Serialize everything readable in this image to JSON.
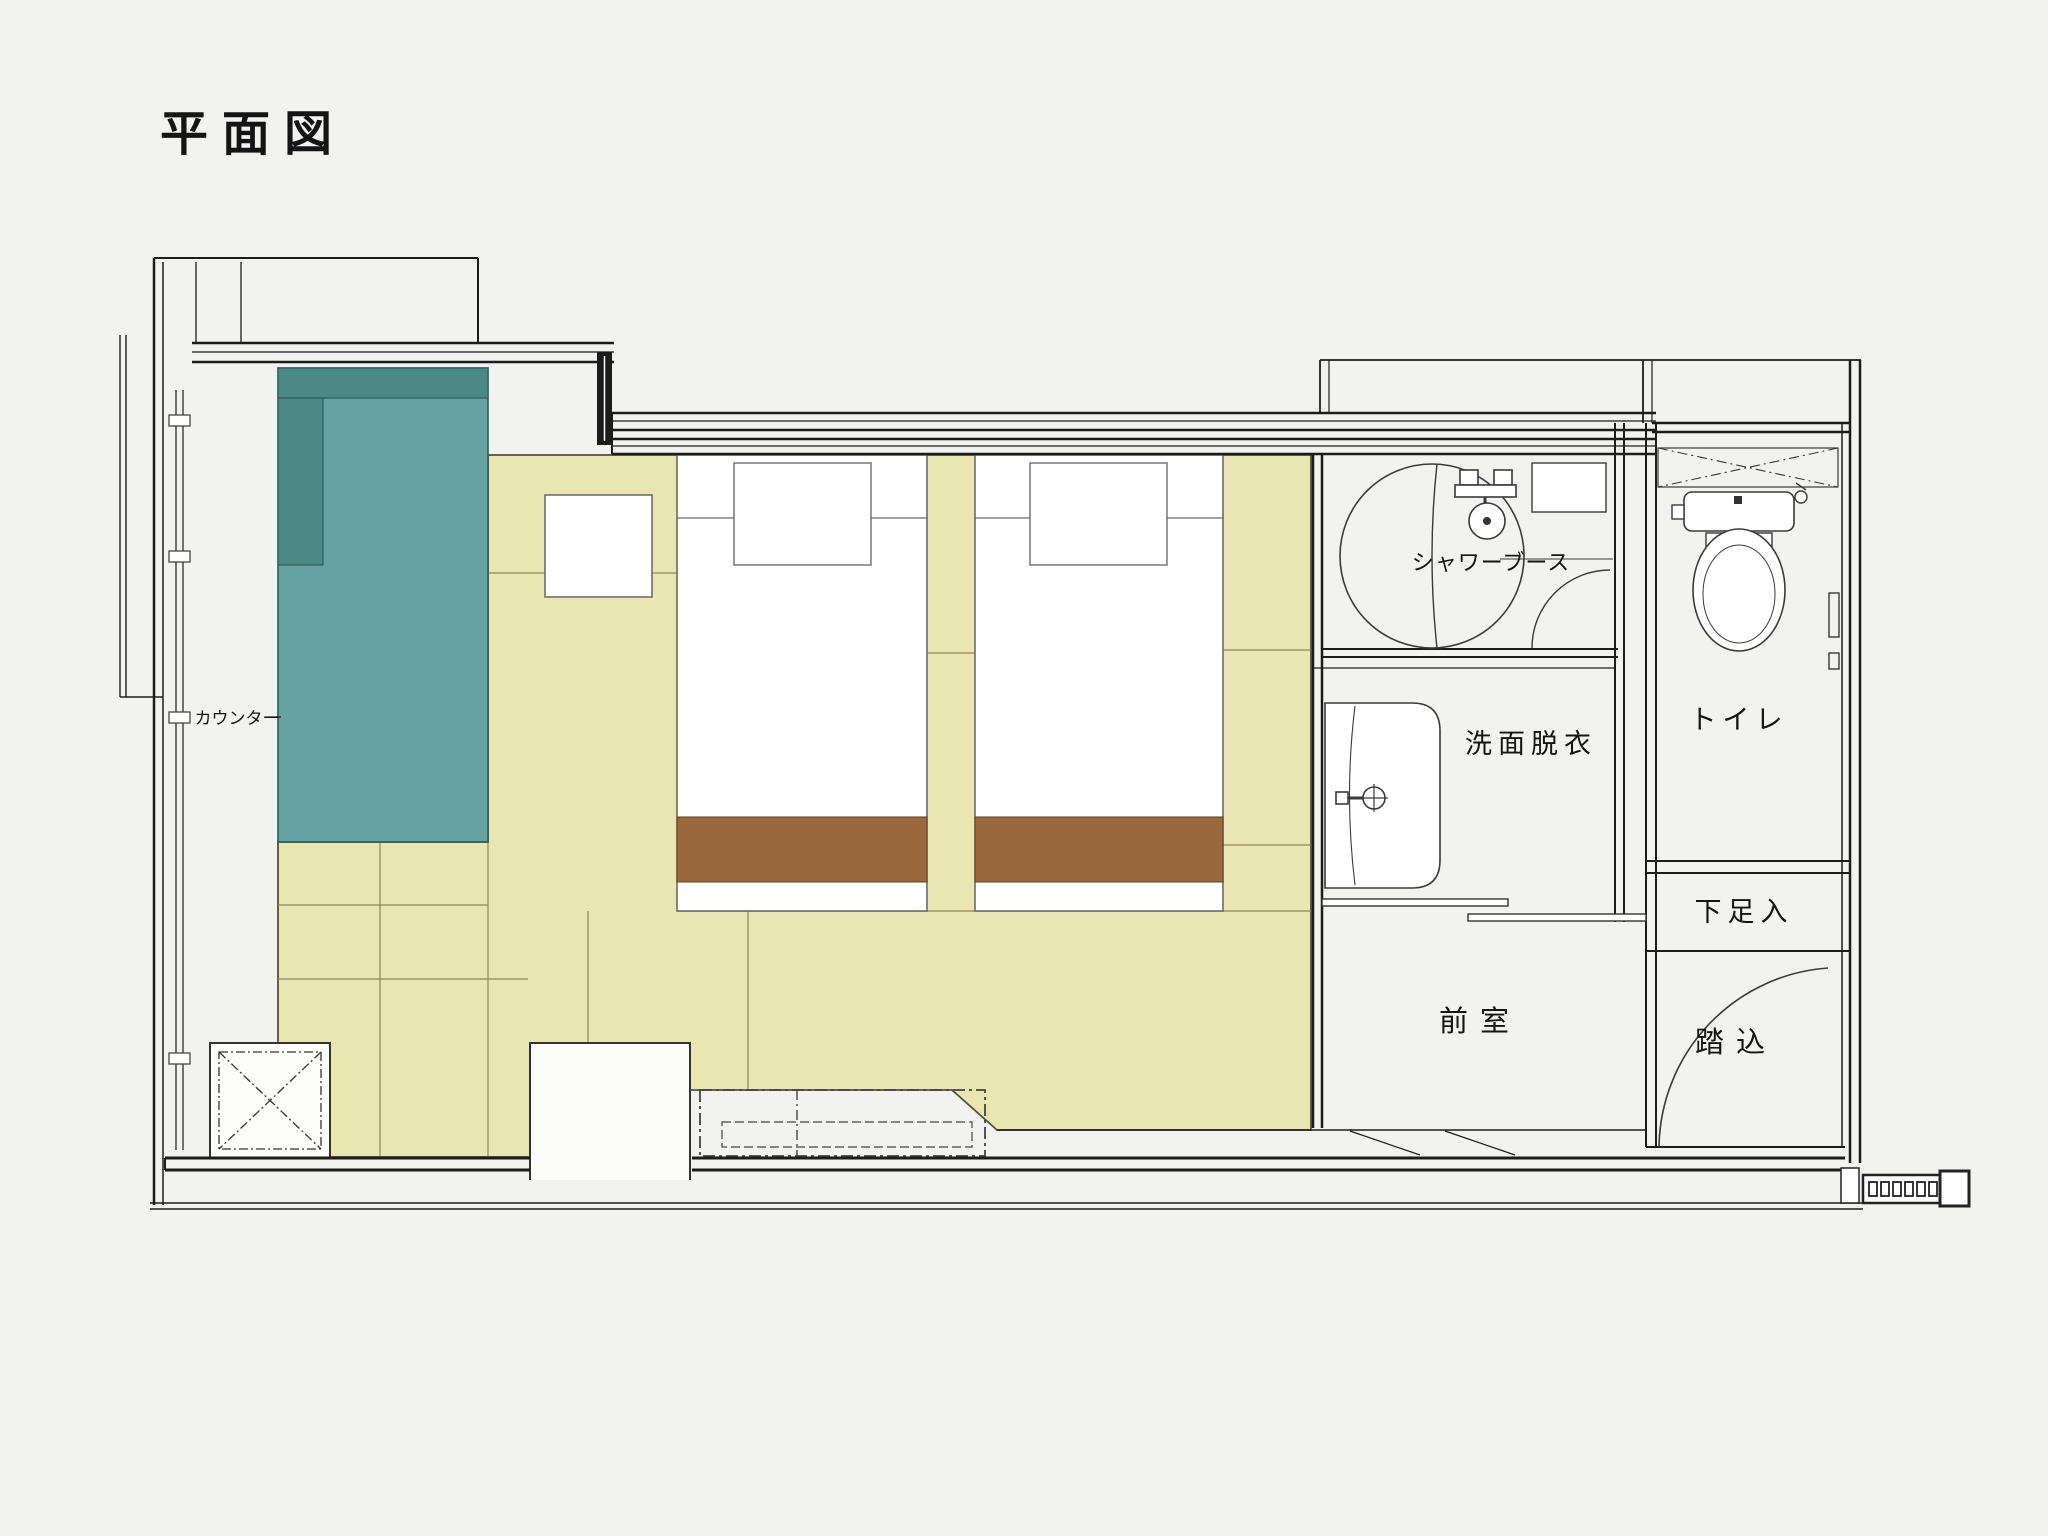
{
  "title": "平面図",
  "labels": {
    "counter": "カウンター",
    "shower_booth": "シャワーブース",
    "washroom": "洗面脱衣",
    "toilet": "トイレ",
    "shoe_storage": "下足入",
    "anteroom": "前室",
    "entry_step": "踏込"
  },
  "colors": {
    "background": "#f2f2f0",
    "wall": "#1c1c1c",
    "tatami": "#eae6b2",
    "tatami_joint": "#8d8756",
    "counter_top": "#66a2a1",
    "counter_top_dark": "#4b8886",
    "bed_runner": "#99683d",
    "line": "#3a3a3a"
  }
}
